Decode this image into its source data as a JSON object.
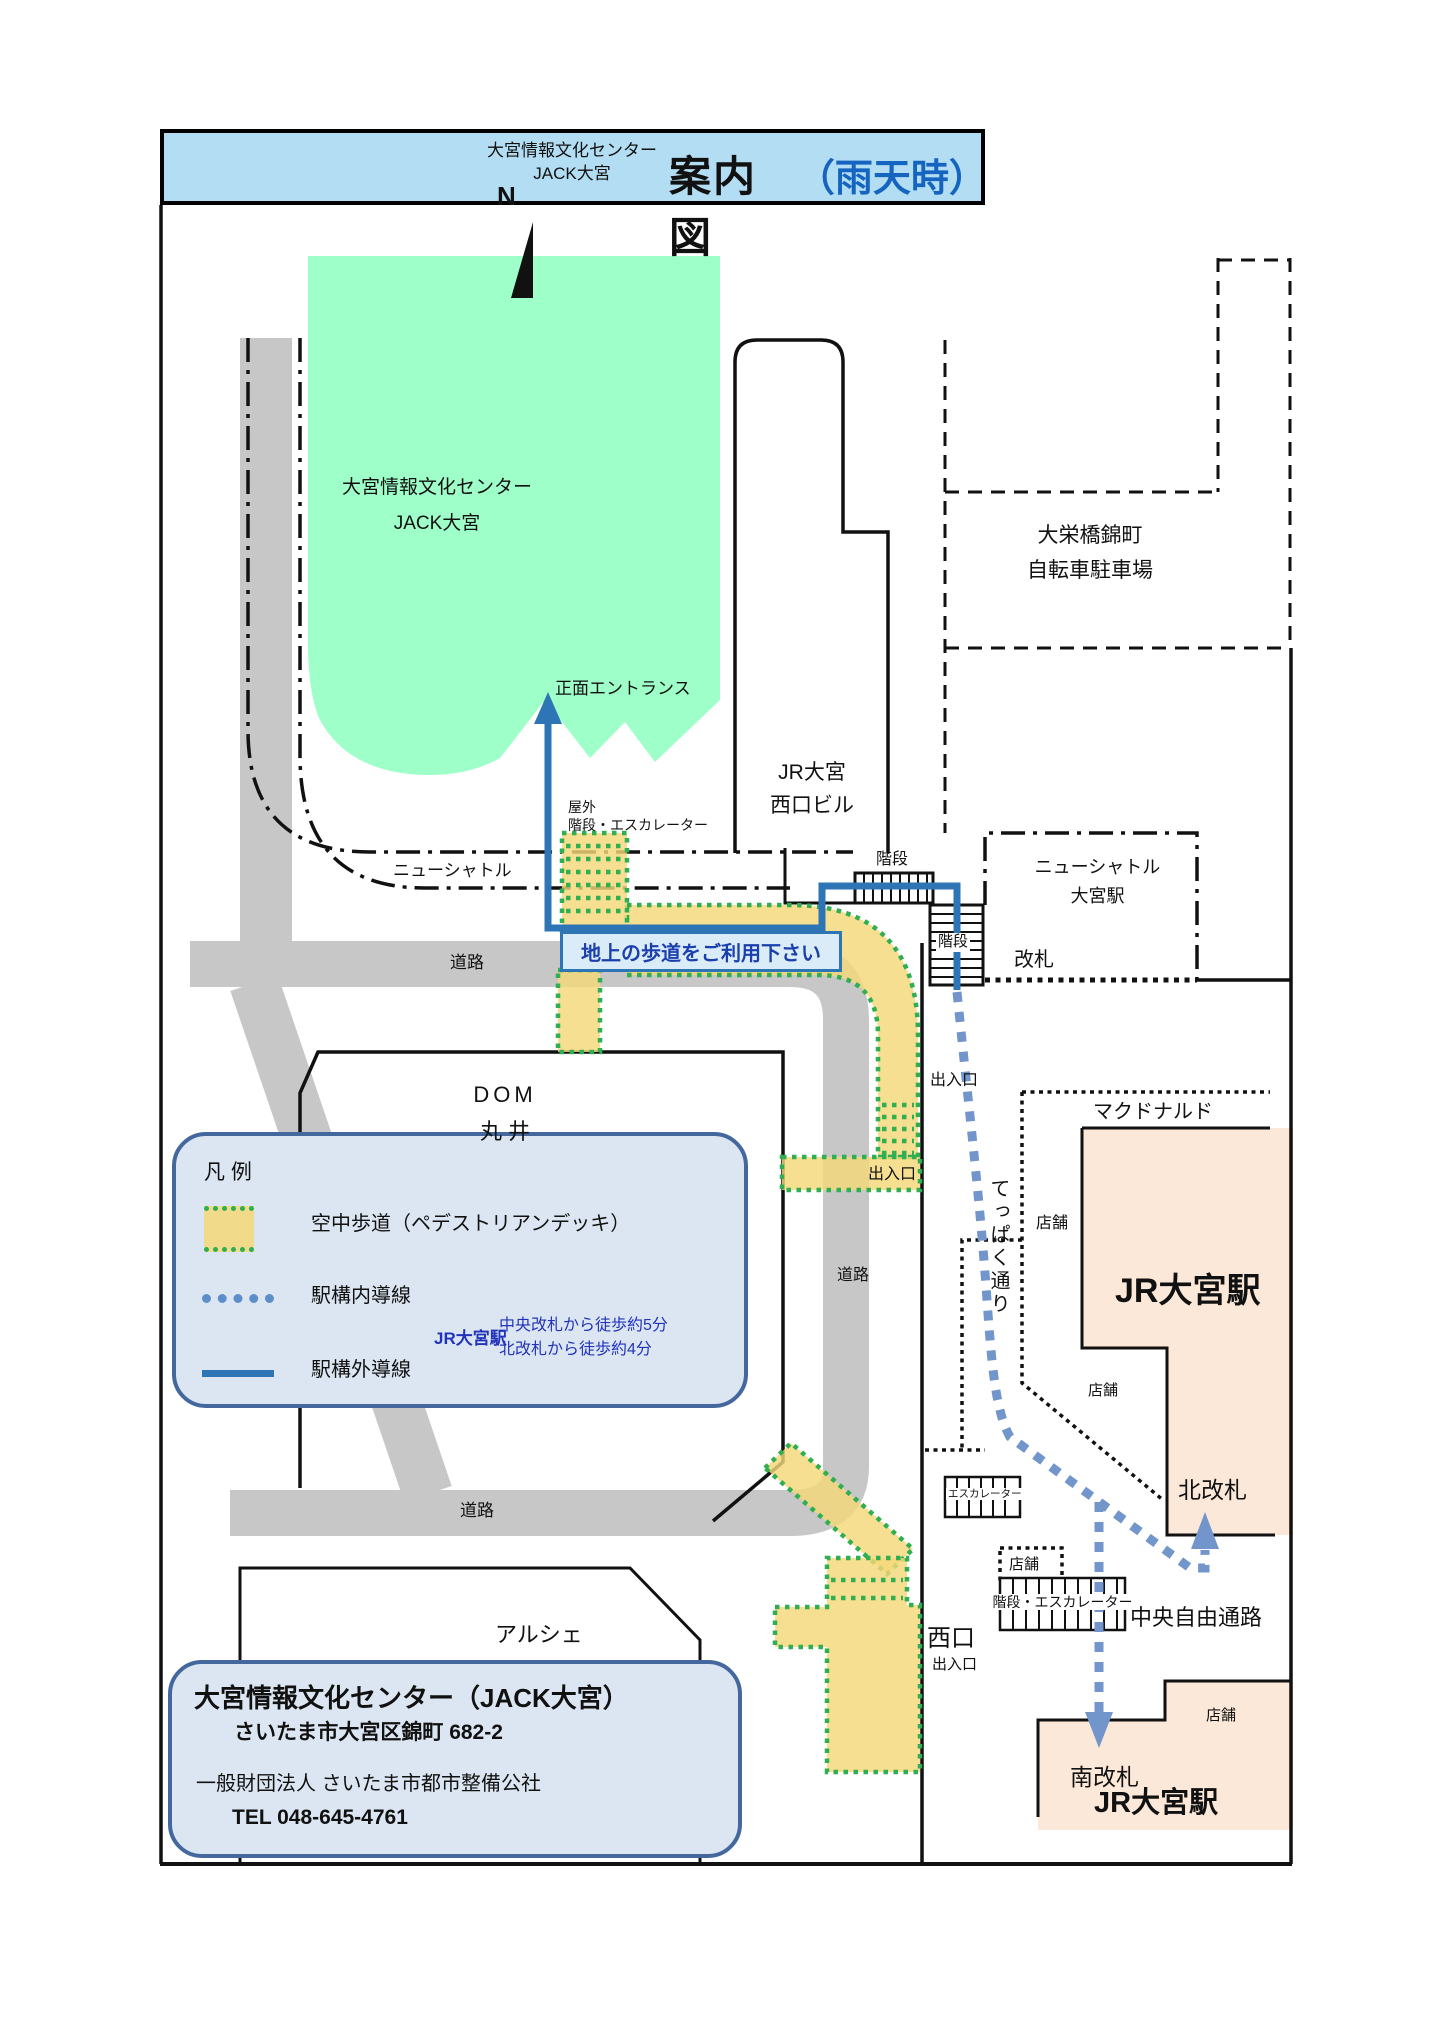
{
  "header": {
    "org_name_line1": "大宮情報文化センター",
    "org_name_line2": "JACK大宮",
    "title": "案内図",
    "title_note": "（雨天時）"
  },
  "compass": {
    "north": "N"
  },
  "map": {
    "jack_building": {
      "name_line1": "大宮情報文化センター",
      "name_line2": "JACK大宮",
      "entrance": "正面エントランス"
    },
    "west_exit_bldg": {
      "line1": "JR大宮",
      "line2": "西口ビル"
    },
    "bicycle_parking": {
      "line1": "大栄橋錦町",
      "line2": "自転車駐車場"
    },
    "new_shuttle": {
      "track": "ニューシャトル",
      "station_line1": "ニューシャトル",
      "station_line2": "大宮駅",
      "gate": "改札"
    },
    "outdoor_stairs": {
      "line1": "屋外",
      "line2": "階段・エスカレーター"
    },
    "stairs_top": "階段",
    "stairs_side": "階段",
    "notice": "地上の歩道をご利用下さい",
    "roads": {
      "top": "道路",
      "center": "道路",
      "bottom": "道路"
    },
    "dom": {
      "line1": "DOM",
      "line2": "丸 井"
    },
    "exits": {
      "deck_upper": "出入口",
      "deck_lower": "出入口",
      "west": "西口",
      "west_sub": "出入口"
    },
    "mcdonalds": "マクドナルド",
    "jr_station": {
      "north_label": "JR大宮駅",
      "south_label": "JR大宮駅",
      "north_gate": "北改札",
      "south_gate": "南改札",
      "central_passage": "中央自由通路"
    },
    "teppaku_street": "てっぱく通り",
    "shops": {
      "a": "店舗",
      "b": "店舗",
      "c": "店舗",
      "d": "店舗"
    },
    "escalator": "エスカレーター",
    "stairs_escalator": "階段・エスカレーター",
    "arche": "アルシェ"
  },
  "legend": {
    "title": "凡 例",
    "items": [
      {
        "label": "空中歩道（ペデストリアンデッキ）"
      },
      {
        "label": "駅構内導線"
      },
      {
        "label": "駅構外導線"
      }
    ],
    "walk_note": {
      "station": "JR大宮駅",
      "line1": "中央改札から徒歩約5分",
      "line2": "北改札から徒歩約4分"
    }
  },
  "info": {
    "title": "大宮情報文化センター（JACK大宮）",
    "address": "さいたま市大宮区錦町 682-2",
    "operator": "一般財団法人 さいたま市都市整備公社",
    "tel": "TEL  048-645-4761"
  },
  "colors": {
    "accent_blue": "#2e75b6",
    "deck_tan": "#f4d878",
    "deck_dot_green": "#2fae52",
    "route_dotted_blue": "#7295cb",
    "building_green": "#9effc8",
    "station_peach": "#fbe8d8",
    "header_blue": "#b3ddf2",
    "panel_blue": "#dbe6f2",
    "road_gray": "#c7c7c7"
  }
}
